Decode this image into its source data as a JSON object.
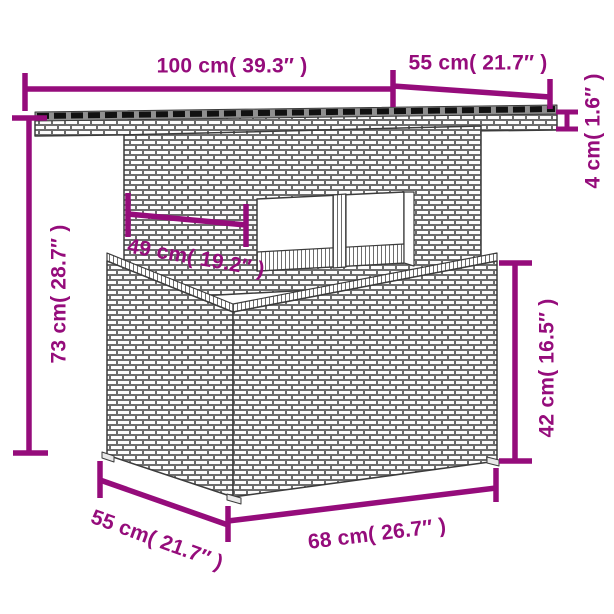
{
  "meta": {
    "subject": "Rattan garden table dimension diagram",
    "accent_color": "#950C7B",
    "outline_color": "#3c3c3c",
    "background_color": "#ffffff"
  },
  "dimensions": {
    "tabletop_width": {
      "label": "100 cm( 39.3″ )"
    },
    "tabletop_depth": {
      "label": "55 cm( 21.7″ )"
    },
    "tabletop_thickness": {
      "label": "4 cm( 1.6″ )"
    },
    "total_height": {
      "label": "73 cm( 28.7″ )"
    },
    "opening_width": {
      "label": "49 cm( 19.2″ )"
    },
    "base_height": {
      "label": "42 cm( 16.5″ )"
    },
    "base_depth": {
      "label": "55 cm( 21.7″ )"
    },
    "base_width": {
      "label": "68 cm( 26.7″ )"
    }
  }
}
